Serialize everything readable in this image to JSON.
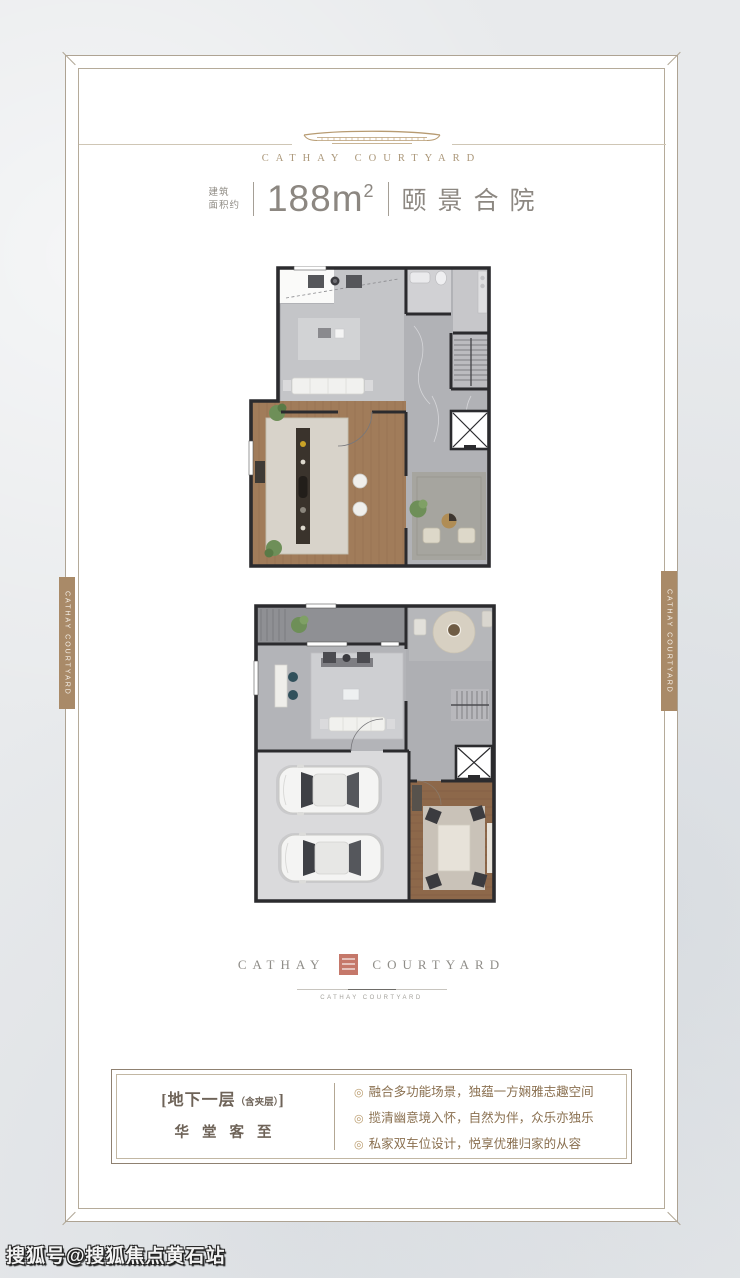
{
  "header": {
    "brand": "CATHAY COURTYARD"
  },
  "spec": {
    "area_label_line1": "建筑",
    "area_label_line2": "面积约",
    "area_value": "188",
    "area_unit": "m",
    "area_unit_sup": "2",
    "project_name": "颐景合院"
  },
  "side_ribbons": {
    "left_text": "CATHAY COURTYARD",
    "right_text": "CATHAY COURTYARD"
  },
  "footer_logo": {
    "word_left": "CATHAY",
    "word_right": "COURTYARD",
    "tagline": "CATHAY COURTYARD"
  },
  "info_box": {
    "title_open": "[",
    "title_main": "地下一层",
    "title_small": "（含夹层）",
    "title_close": "]",
    "subtitle": "华堂客至",
    "bullet_symbol": "◎",
    "bullets": [
      "融合多功能场景，独蕴一方娴雅志趣空间",
      "揽清幽意境入怀，自然为伴，众乐亦独乐",
      "私家双车位设计，悦享优雅归家的从容"
    ]
  },
  "watermark": "搜狐号@搜狐焦点黄石站",
  "colors": {
    "gold": "#ab9779",
    "ribbon": "#a98a68",
    "seal": "#c5786a",
    "frame": "#aea393",
    "spec_text": "#8c8781",
    "bullet_text": "#8a7050",
    "wall": "#2b2b2e"
  }
}
